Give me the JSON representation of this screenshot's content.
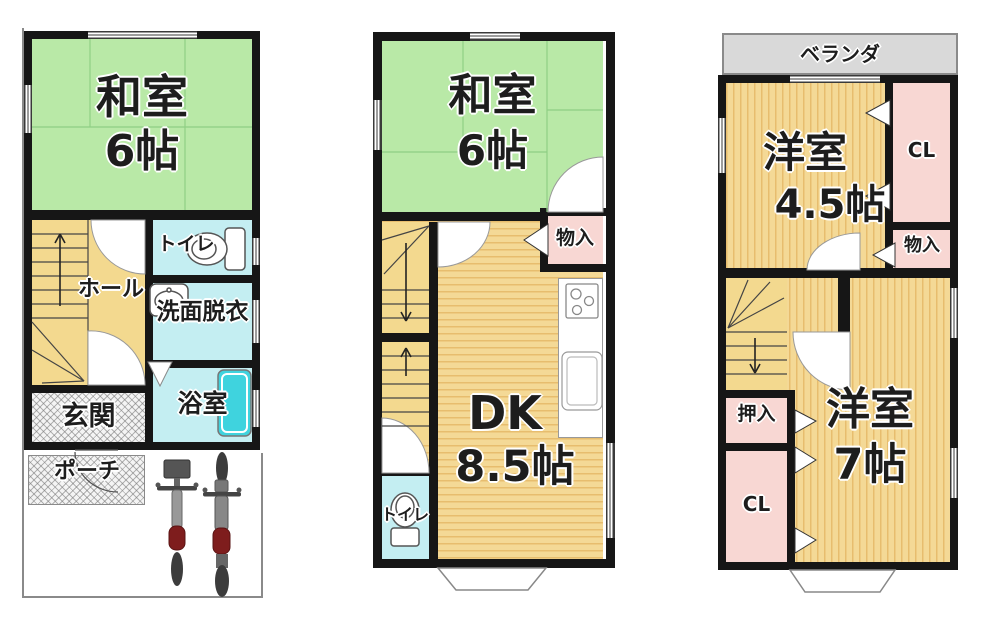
{
  "floor1": {
    "washitsu": {
      "name": "和室",
      "size": "6帖"
    },
    "toilet": "トイレ",
    "hall": "ホール",
    "washroom": "洗面脱衣",
    "bathroom": "浴室",
    "entrance": "玄関",
    "porch": "ポーチ"
  },
  "floor2": {
    "washitsu": {
      "name": "和室",
      "size": "6帖"
    },
    "storage": "物入",
    "dk": {
      "name": "DK",
      "size": "8.5帖"
    },
    "toilet": "トイレ"
  },
  "floor3": {
    "veranda": "ベランダ",
    "room_small": {
      "name": "洋室",
      "size": "4.5帖"
    },
    "closet_upper": "CL",
    "storage": "物入",
    "oshiire": "押入",
    "closet_lower": "CL",
    "room_large": {
      "name": "洋室",
      "size": "7帖"
    }
  },
  "colors": {
    "tatami_green": "#b9e9a7",
    "flooring_light": "#f4d996",
    "flooring_dark": "#e7bd6e",
    "stair_yellow": "#f3d98f",
    "water_blue": "#c4eef2",
    "bathtub_teal": "#3fd3de",
    "closet_pink": "#f8d7d3",
    "veranda_gray": "#d9d9d9",
    "wall_black": "#161616",
    "seat_red": "#7e1d1d"
  }
}
